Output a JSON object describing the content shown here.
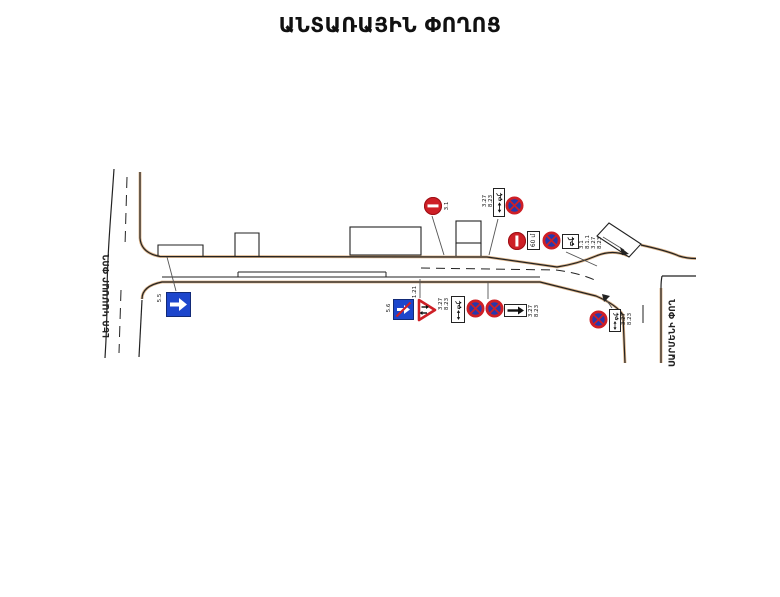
{
  "page": {
    "title": "ԱՆՏԱՌԱՅԻՆ ՓՈՂՈՑ"
  },
  "streets": {
    "left_vertical": "ԼԵՌ ԿԱՄՍԱՐ ՓՈՂ",
    "right_vertical": "ՍԱՐՄԵՆԻ ՓՈՂ"
  },
  "sign_labels": {
    "top_no_entry": "3.1",
    "top_plate": [
      "3.27",
      "8.23"
    ],
    "east_group": [
      "3.1",
      "8.1.1",
      "3.27",
      "8.23"
    ],
    "east_distance_plate": "60 մ",
    "west_one_way": "5.5",
    "end_one_way": "5.6",
    "two_way_warning": "1.21",
    "mid_tow": [
      "3.27",
      "8.23"
    ],
    "mid_zone": [
      "3.27",
      "8.23"
    ],
    "southeast_tow": [
      "3.27",
      "8.23"
    ]
  },
  "icons": {
    "no_entry": "no-entry-sign-icon",
    "no_stopping": "no-stopping-sign-icon",
    "one_way": "one-way-arrow-sign-icon",
    "end_one_way": "end-of-one-way-sign-icon",
    "two_way_warning": "two-way-traffic-warning-icon",
    "tow_truck_plate": "tow-truck-plate-icon",
    "direction_arrow_plate": "direction-arrow-plate-icon",
    "distance_plate": "distance-plate"
  },
  "colors": {
    "sign_red": "#ce1f26",
    "sign_blue_disc": "#2838ac",
    "sign_blue_square": "#1d46cc",
    "road_edge_tan": "#d6a979",
    "line_black": "#222222"
  }
}
